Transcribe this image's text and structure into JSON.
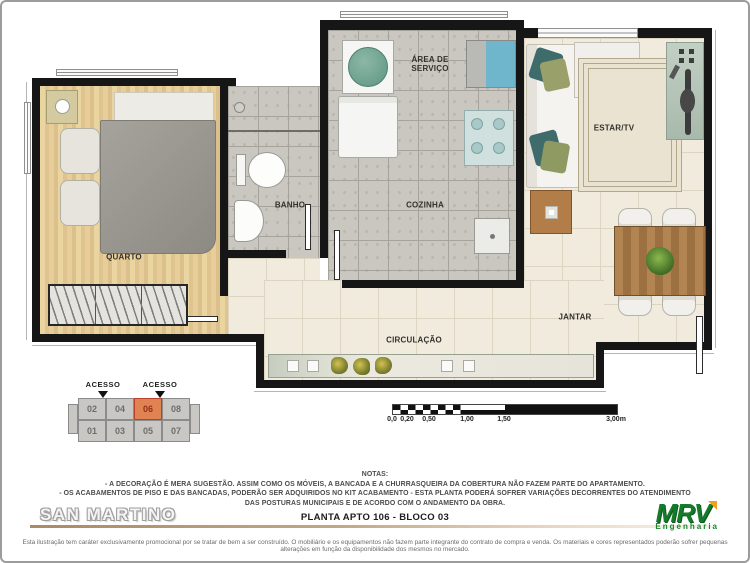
{
  "plan": {
    "rooms": {
      "quarto": "QUARTO",
      "banho": "BANHO",
      "cozinha": "COZINHA",
      "area_servico_line1": "ÁREA DE",
      "area_servico_line2": "SERVIÇO",
      "estar_tv": "ESTAR/TV",
      "jantar": "JANTAR",
      "circulacao": "CIRCULAÇÃO"
    }
  },
  "keyplan": {
    "acesso": "ACESSO",
    "units_top": [
      "02",
      "04",
      "06",
      "08"
    ],
    "units_bottom": [
      "01",
      "03",
      "05",
      "07"
    ],
    "highlighted_unit": "06",
    "highlight_color": "#e08252"
  },
  "scalebar": {
    "labels": [
      "0,0",
      "0,20",
      "0,50",
      "1,00",
      "1,50",
      "3,00m"
    ]
  },
  "notes": {
    "title": "NOTAS:",
    "line1": "- A DECORAÇÃO É MERA SUGESTÃO. ASSIM COMO OS MÓVEIS, A BANCADA E A CHURRASQUEIRA DA COBERTURA NÃO FAZEM PARTE DO APARTAMENTO.",
    "line2": "- OS ACABAMENTOS DE PISO E DAS BANCADAS, PODERÃO SER ADQUIRIDOS NO KIT ACABAMENTO  -  ESTA PLANTA PODERÁ SOFRER VARIAÇÕES DECORRENTES DO ATENDIMENTO",
    "line3": "DAS POSTURAS  MUNICIPAIS E DE ACORDO COM O ANDAMENTO DA OBRA."
  },
  "footer": {
    "project_name": "SAN MARTINO",
    "plan_title": "PLANTA  APTO 106 - BLOCO 03",
    "logo_text": "MRV",
    "logo_subtext": "Engenharia",
    "logo_green": "#157a2a",
    "logo_accent": "#f0a01e",
    "underline_color": "#b08a67",
    "disclaimer": "Esta ilustração tem caráter exclusivamente promocional por se tratar de bem a ser construído. O mobiliário e os equipamentos não fazem parte integrante do contrato de compra e venda. Os materiais e cores representados poderão sofrer pequenas alterações em função da disponibilidade dos mesmos no mercado."
  }
}
